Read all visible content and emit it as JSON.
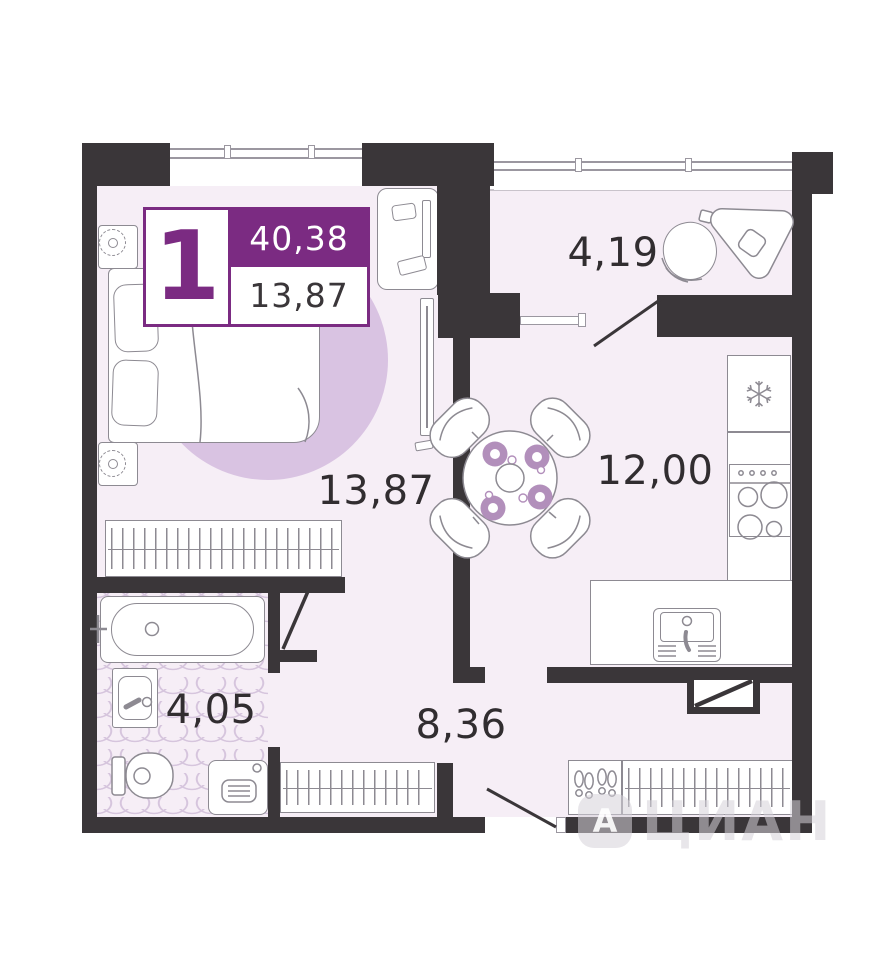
{
  "badge": {
    "rooms_count": "1",
    "total_area": "40,38",
    "living_area": "13,87"
  },
  "rooms": {
    "living_room": {
      "area": "13,87"
    },
    "balcony": {
      "area": "4,19"
    },
    "kitchen": {
      "area": "12,00"
    },
    "bathroom": {
      "area": "4,05"
    },
    "hallway": {
      "area": "8,36"
    }
  },
  "watermark": {
    "logo_letter": "А",
    "brand": "ЦИАН"
  },
  "colors": {
    "wall": "#3a3639",
    "floor": "#f6eef6",
    "rug": "#d9c3e2",
    "line": "#8d8a92",
    "accent": "#7b2b82",
    "plate": "#b28fbb",
    "wave": "#cfbcd8",
    "text": "#312d30"
  }
}
